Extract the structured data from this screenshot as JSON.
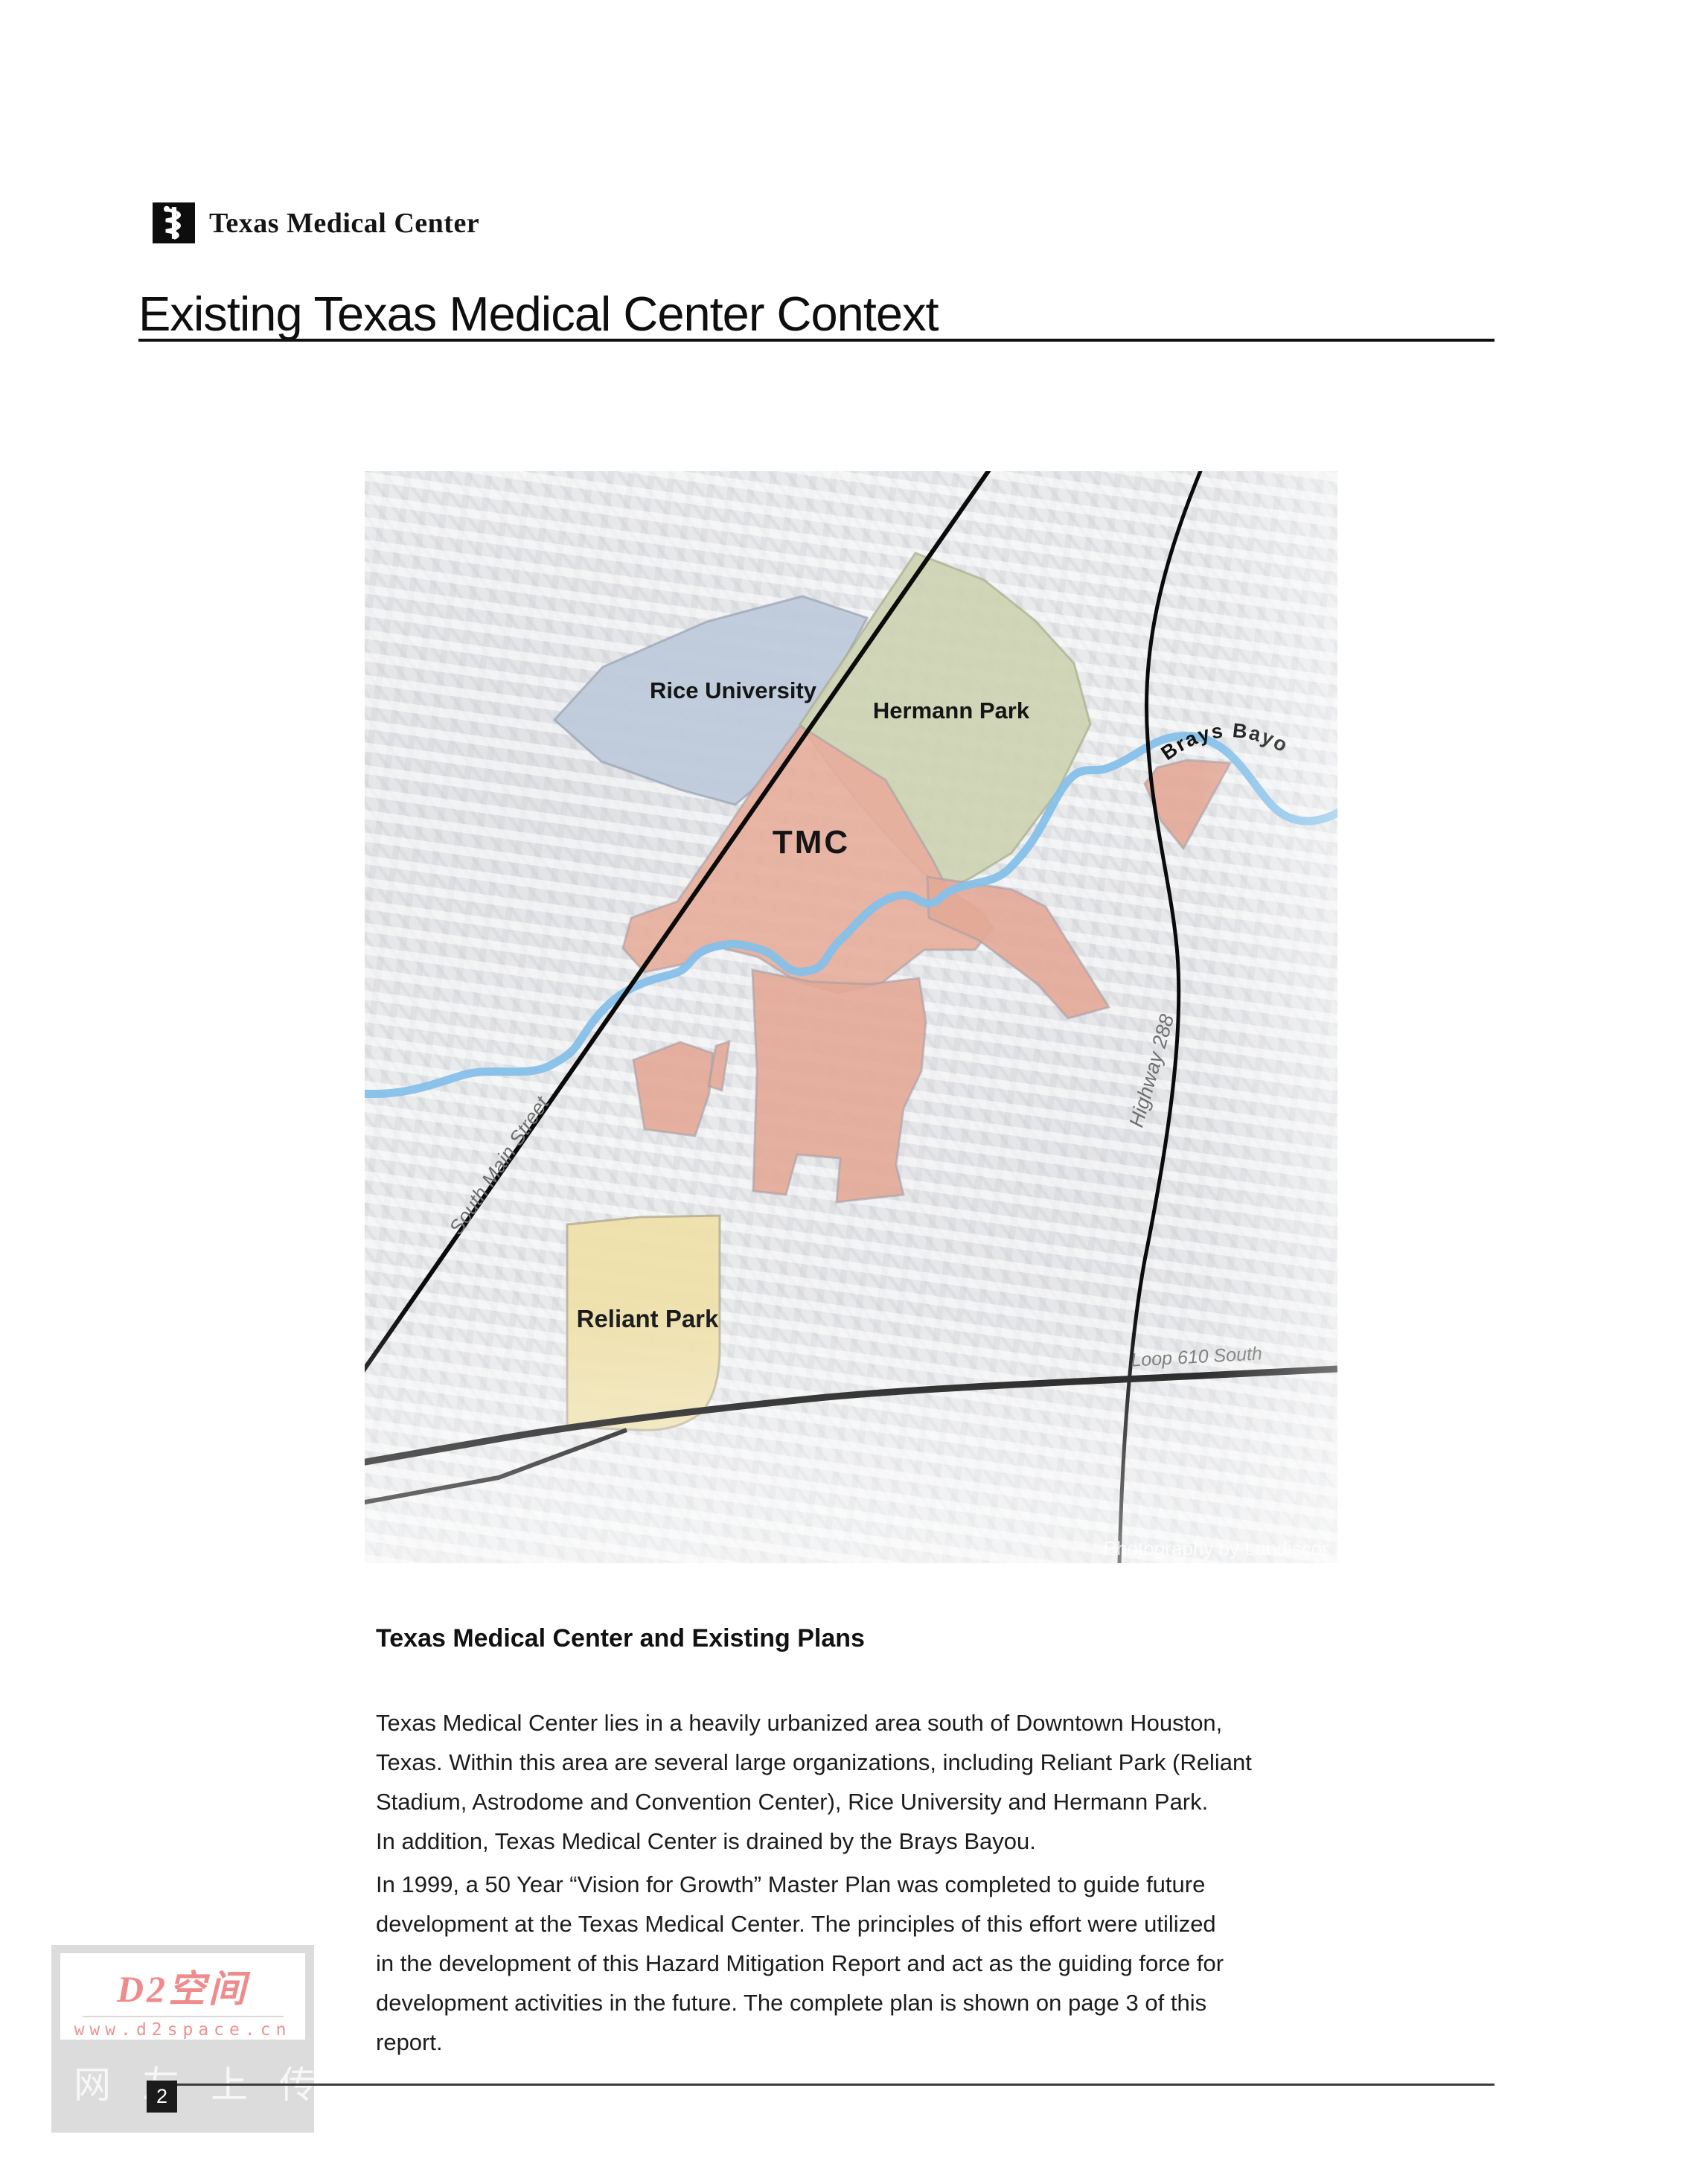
{
  "header": {
    "brand": "Texas Medical Center",
    "page_title": "Existing Texas Medical Center Context"
  },
  "map": {
    "labels": {
      "rice": "Rice University",
      "hermann": "Hermann Park",
      "tmc": "TMC",
      "reliant": "Reliant Park",
      "bayou": "Brays Bayou",
      "south_main": "South Main Street",
      "highway_288": "Highway 288",
      "loop_610": "Loop 610 South",
      "credit": "Photography by Landiscor"
    },
    "colors": {
      "rice": "#bdc9da",
      "hermann": "#cdd2b2",
      "tmc": "#e7ad9b",
      "tmc_outlying": "#e3a897",
      "reliant": "#eee0ab",
      "bayou": "#85c0ea",
      "road": "#0b0b0b",
      "area_stroke": "#9b9ba5"
    }
  },
  "content": {
    "heading": "Texas Medical Center and Existing Plans",
    "paragraph1_lines": [
      "Texas Medical Center lies in a heavily urbanized area south of Downtown Houston,",
      "Texas.  Within this area are several large organizations, including Reliant Park (Reliant",
      "Stadium, Astrodome and Convention Center), Rice University and Hermann Park.",
      "In addition, Texas Medical Center is drained by the Brays Bayou."
    ],
    "paragraph2_lines": [
      "In 1999, a 50 Year “Vision for Growth” Master Plan was completed to guide future",
      "development at the Texas Medical Center.  The principles of this effort were utilized",
      "in the development of this Hazard Mitigation Report and act as the guiding force for",
      "development activities in the future.  The complete plan is shown on page 3 of this",
      "report."
    ]
  },
  "watermark": {
    "logo": "D2空间",
    "url": "www.d2space.cn",
    "caption": "网友上传"
  },
  "footer": {
    "page_number": "2"
  }
}
